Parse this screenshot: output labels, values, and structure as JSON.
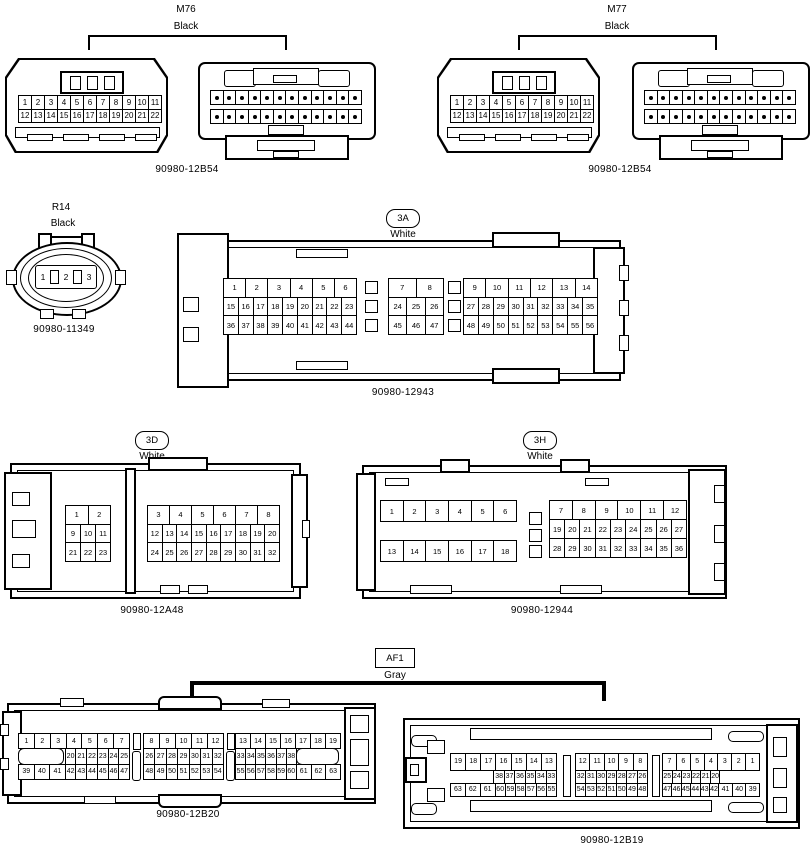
{
  "page": {
    "background": "#ffffff",
    "line_color": "#000000"
  },
  "sections": {
    "m76": {
      "name": "M76",
      "color": "Black",
      "part": "90980-12B54",
      "dots": 12,
      "front": {
        "rows": [
          [
            "1",
            "2",
            "3",
            "4",
            "5",
            "6",
            "7",
            "8",
            "9",
            "10",
            "11"
          ],
          [
            "12",
            "13",
            "14",
            "15",
            "16",
            "17",
            "18",
            "19",
            "20",
            "21",
            "22"
          ]
        ]
      }
    },
    "m77": {
      "name": "M77",
      "color": "Black",
      "part": "90980-12B54",
      "dots": 12,
      "front": {
        "rows": [
          [
            "1",
            "2",
            "3",
            "4",
            "5",
            "6",
            "7",
            "8",
            "9",
            "10",
            "11"
          ],
          [
            "12",
            "13",
            "14",
            "15",
            "16",
            "17",
            "18",
            "19",
            "20",
            "21",
            "22"
          ]
        ]
      }
    },
    "r14": {
      "name": "R14",
      "color": "Black",
      "part": "90980-11349",
      "pins": [
        "1",
        "2",
        "3"
      ]
    },
    "c3a": {
      "name": "3A",
      "color": "White",
      "part": "90980-12943",
      "blocks": [
        {
          "rows": [
            [
              "1",
              "2",
              "3",
              "4",
              "5",
              "6"
            ],
            [
              "15",
              "16",
              "17",
              "18",
              "19",
              "20",
              "21",
              "22",
              "23"
            ],
            [
              "36",
              "37",
              "38",
              "39",
              "40",
              "41",
              "42",
              "43",
              "44"
            ]
          ]
        },
        {
          "rows": [
            [
              "7",
              "8"
            ],
            [
              "24",
              "25",
              "26"
            ],
            [
              "45",
              "46",
              "47"
            ]
          ]
        },
        {
          "rows": [
            [
              "9",
              "10",
              "11",
              "12",
              "13",
              "14"
            ],
            [
              "27",
              "28",
              "29",
              "30",
              "31",
              "32",
              "33",
              "34",
              "35"
            ],
            [
              "48",
              "49",
              "50",
              "51",
              "52",
              "53",
              "54",
              "55",
              "56"
            ]
          ]
        }
      ]
    },
    "c3d": {
      "name": "3D",
      "color": "White",
      "part": "90980-12A48",
      "blocks": [
        {
          "rows": [
            [
              "1",
              "2"
            ],
            [
              "9",
              "10",
              "11"
            ],
            [
              "21",
              "22",
              "23"
            ]
          ]
        },
        {
          "rows": [
            [
              "3",
              "4",
              "5",
              "6",
              "7",
              "8"
            ],
            [
              "12",
              "13",
              "14",
              "15",
              "16",
              "17",
              "18",
              "19",
              "20"
            ],
            [
              "24",
              "25",
              "26",
              "27",
              "28",
              "29",
              "30",
              "31",
              "32"
            ]
          ]
        }
      ]
    },
    "c3h": {
      "name": "3H",
      "color": "White",
      "part": "90980-12944",
      "blocks": [
        {
          "rows": [
            [
              "1",
              "2",
              "3",
              "4",
              "5",
              "6"
            ],
            [
              "13",
              "14",
              "15",
              "16",
              "17",
              "18"
            ]
          ]
        },
        {
          "rows": [
            [
              "7",
              "8",
              "9",
              "10",
              "11",
              "12"
            ],
            [
              "19",
              "20",
              "21",
              "22",
              "23",
              "24",
              "25",
              "26",
              "27"
            ],
            [
              "28",
              "29",
              "30",
              "31",
              "32",
              "33",
              "34",
              "35",
              "36"
            ]
          ]
        }
      ]
    },
    "af1": {
      "name": "AF1",
      "color": "Gray",
      "left": {
        "part": "90980-12B20",
        "blocks": [
          {
            "rows": [
              [
                "1",
                "2",
                "3",
                "4",
                "5",
                "6",
                "7"
              ],
              [
                {
                  "k": "blank",
                  "w": 9
                },
                {
                  "t": "20",
                  "w": 2
                },
                {
                  "t": "21",
                  "w": 2
                },
                {
                  "t": "22",
                  "w": 2
                },
                {
                  "t": "23",
                  "w": 2
                },
                {
                  "t": "24",
                  "w": 2
                },
                {
                  "t": "25",
                  "w": 2
                }
              ],
              [
                {
                  "t": "39",
                  "w": 3
                },
                {
                  "t": "40",
                  "w": 3
                },
                {
                  "t": "41",
                  "w": 3
                },
                {
                  "t": "42",
                  "w": 2
                },
                {
                  "t": "43",
                  "w": 2
                },
                {
                  "t": "44",
                  "w": 2
                },
                {
                  "t": "45",
                  "w": 2
                },
                {
                  "t": "46",
                  "w": 2
                },
                {
                  "t": "47",
                  "w": 2
                }
              ]
            ]
          },
          {
            "rows": [
              [
                "8",
                "9",
                "10",
                "11",
                "12"
              ],
              [
                "26",
                "27",
                "28",
                "29",
                "30",
                "31",
                "32"
              ],
              [
                "48",
                "49",
                "50",
                "51",
                "52",
                "53",
                "54"
              ]
            ]
          },
          {
            "rows": [
              [
                "13",
                "14",
                "15",
                "16",
                "17",
                "18",
                "19"
              ],
              [
                {
                  "t": "33",
                  "w": 2
                },
                {
                  "t": "34",
                  "w": 2
                },
                {
                  "t": "35",
                  "w": 2
                },
                {
                  "t": "36",
                  "w": 2
                },
                {
                  "t": "37",
                  "w": 2
                },
                {
                  "t": "38",
                  "w": 2
                },
                {
                  "k": "blank",
                  "w": 9
                }
              ],
              [
                {
                  "t": "55",
                  "w": 2
                },
                {
                  "t": "56",
                  "w": 2
                },
                {
                  "t": "57",
                  "w": 2
                },
                {
                  "t": "58",
                  "w": 2
                },
                {
                  "t": "59",
                  "w": 2
                },
                {
                  "t": "60",
                  "w": 2
                },
                {
                  "t": "61",
                  "w": 3
                },
                {
                  "t": "62",
                  "w": 3
                },
                {
                  "t": "63",
                  "w": 3
                }
              ]
            ]
          }
        ]
      },
      "right": {
        "part": "90980-12B19",
        "blocks": [
          {
            "rows": [
              [
                "19",
                "18",
                "17",
                "16",
                "15",
                "14",
                "13"
              ],
              [
                {
                  "k": "space",
                  "w": 9
                },
                {
                  "t": "38",
                  "w": 2
                },
                {
                  "t": "37",
                  "w": 2
                },
                {
                  "t": "36",
                  "w": 2
                },
                {
                  "t": "35",
                  "w": 2
                },
                {
                  "t": "34",
                  "w": 2
                },
                {
                  "t": "33",
                  "w": 2
                }
              ],
              [
                {
                  "t": "63",
                  "w": 3
                },
                {
                  "t": "62",
                  "w": 3
                },
                {
                  "t": "61",
                  "w": 3
                },
                {
                  "t": "60",
                  "w": 2
                },
                {
                  "t": "59",
                  "w": 2
                },
                {
                  "t": "58",
                  "w": 2
                },
                {
                  "t": "57",
                  "w": 2
                },
                {
                  "t": "56",
                  "w": 2
                },
                {
                  "t": "55",
                  "w": 2
                }
              ]
            ]
          },
          {
            "rows": [
              [
                "12",
                "11",
                "10",
                "9",
                "8"
              ],
              [
                "32",
                "31",
                "30",
                "29",
                "28",
                "27",
                "26"
              ],
              [
                "54",
                "53",
                "52",
                "51",
                "50",
                "49",
                "48"
              ]
            ]
          },
          {
            "rows": [
              [
                "7",
                "6",
                "5",
                "4",
                "3",
                "2",
                "1"
              ],
              [
                {
                  "t": "25",
                  "w": 2
                },
                {
                  "t": "24",
                  "w": 2
                },
                {
                  "t": "23",
                  "w": 2
                },
                {
                  "t": "22",
                  "w": 2
                },
                {
                  "t": "21",
                  "w": 2
                },
                {
                  "t": "20",
                  "w": 2
                },
                {
                  "k": "space",
                  "w": 9
                }
              ],
              [
                {
                  "t": "47",
                  "w": 2
                },
                {
                  "t": "46",
                  "w": 2
                },
                {
                  "t": "45",
                  "w": 2
                },
                {
                  "t": "44",
                  "w": 2
                },
                {
                  "t": "43",
                  "w": 2
                },
                {
                  "t": "42",
                  "w": 2
                },
                {
                  "t": "41",
                  "w": 3
                },
                {
                  "t": "40",
                  "w": 3
                },
                {
                  "t": "39",
                  "w": 3
                }
              ]
            ]
          }
        ]
      }
    }
  }
}
